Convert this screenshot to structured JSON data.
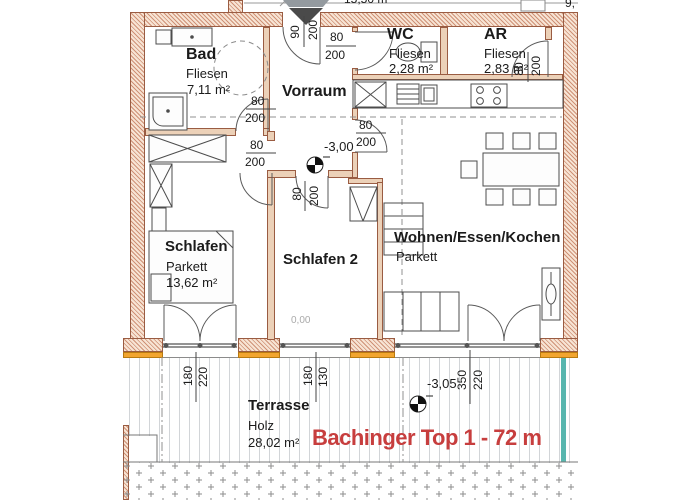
{
  "rooms": {
    "bad": {
      "name": "Bad",
      "floor": "Fliesen",
      "area": "7,11 m²"
    },
    "vorraum": {
      "name": "Vorraum"
    },
    "wc": {
      "name": "WC",
      "floor": "Fliesen",
      "area": "2,28 m²"
    },
    "ar": {
      "name": "AR",
      "floor": "Fliesen",
      "area": "2,83 m²"
    },
    "schlafen": {
      "name": "Schlafen",
      "floor": "Parkett",
      "area": "13,62 m²"
    },
    "schlafen2": {
      "name": "Schlafen 2"
    },
    "wohnen": {
      "name": "Wohnen/Essen/Kochen",
      "floor": "Parkett"
    },
    "terrasse": {
      "name": "Terrasse",
      "floor": "Holz",
      "area": "28,02 m²"
    }
  },
  "levels": {
    "vorraum": "-3,00",
    "terrasse": "-3,05",
    "door_sill": "0,00"
  },
  "dims": {
    "entrance": {
      "a": "90",
      "b": "200"
    },
    "wc_door": {
      "a": "80",
      "b": "200"
    },
    "ar_door": {
      "a": "80",
      "b": "200"
    },
    "bad_door": {
      "a": "80",
      "b": "200"
    },
    "schlafen_door": {
      "a": "80",
      "b": "200"
    },
    "schlafen2_door": {
      "a": "80",
      "b": "200"
    },
    "wohnen_door": {
      "a": "80",
      "b": "200"
    },
    "terrace_door_schlafen": {
      "a": "180",
      "b": "220"
    },
    "terrace_window_schlafen2": {
      "a": "180",
      "b": "130"
    },
    "terrace_door_wohnen": {
      "a": "350",
      "b": "220"
    }
  },
  "edge_texts": {
    "top": "15,50 m",
    "top_right": "9,"
  },
  "title_overlay": {
    "label": "Bachinger Top 1 - 72 m",
    "color": "#c73e3e"
  },
  "colors": {
    "wall_fill": "#f7e4d4",
    "wall_hatch": "#cf9176",
    "wall_line": "#9a5c42",
    "sill_orange": "#f2a52f",
    "terrace_edge_teal": "#58b6ae",
    "overlay_red": "#c73e3e"
  }
}
